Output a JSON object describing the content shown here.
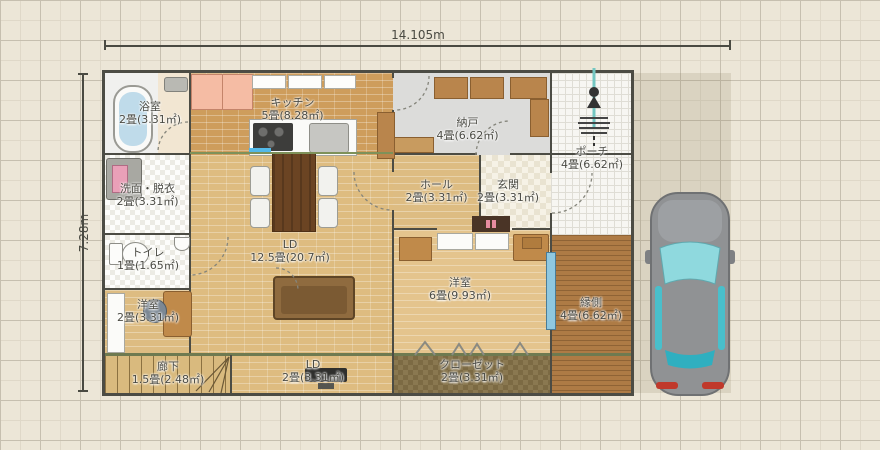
{
  "plan": {
    "width_label": "14.105m",
    "height_label": "7.28m"
  },
  "rooms": {
    "bathroom": {
      "name": "浴室",
      "size": "2畳(3.31㎡)"
    },
    "washroom": {
      "name": "洗面・脱衣",
      "size": "2畳(3.31㎡)"
    },
    "toilet": {
      "name": "トイレ",
      "size": "1畳(1.65㎡)"
    },
    "study": {
      "name": "洋室",
      "size": "2畳(3.31㎡)"
    },
    "corridor": {
      "name": "廊下",
      "size": "1.5畳(2.48㎡)"
    },
    "kitchen": {
      "name": "キッチン",
      "size": "5畳(8.28㎡)"
    },
    "living": {
      "name": "LD",
      "size": "12.5畳(20.7㎡)"
    },
    "living2": {
      "name": "LD",
      "size": "2畳(3.31㎡)"
    },
    "storage": {
      "name": "納戸",
      "size": "4畳(6.62㎡)"
    },
    "hall": {
      "name": "ホール",
      "size": "2畳(3.31㎡)"
    },
    "entrance": {
      "name": "玄関",
      "size": "2畳(3.31㎡)"
    },
    "western": {
      "name": "洋室",
      "size": "6畳(9.93㎡)"
    },
    "veranda": {
      "name": "縁側",
      "size": "4畳(6.62㎡)"
    },
    "closet": {
      "name": "クローゼット",
      "size": "2畳(3.31㎡)"
    },
    "porch": {
      "name": "ポーチ",
      "size": "4畳(6.62㎡)"
    }
  },
  "colors": {
    "background": "#ECE6D7",
    "grid_major": "#C6BFAF",
    "wall": "#4C4C44",
    "accent_green": "#6E7A50",
    "wood_light": "#DEBC80",
    "wood_kitchen": "#CE9D5C",
    "veranda_wood": "#AE7B45",
    "sliding_door_blue": "#8FC8E0",
    "car_body": "#909294",
    "car_window": "#49BFCB"
  }
}
